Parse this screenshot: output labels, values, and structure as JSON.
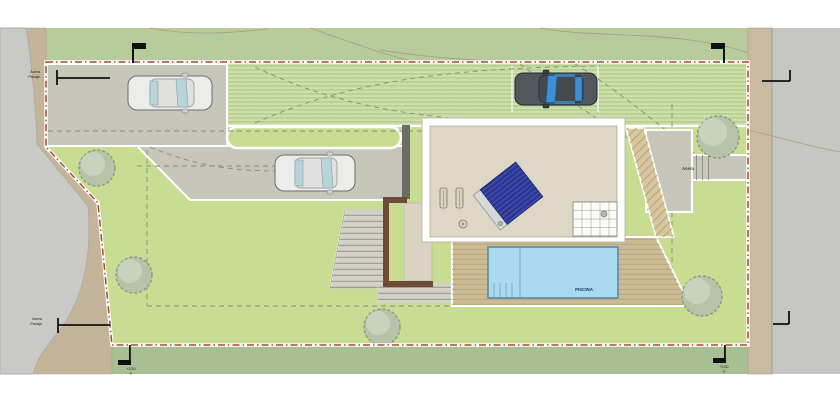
{
  "plan": {
    "pool_label": "PISCINA",
    "sidewalk_label_right": "Acera",
    "street_label_top": {
      "line1": "Acera",
      "line2": "Pasaje"
    },
    "street_label_bottom": {
      "line1": "Acera",
      "line2": "Pasaje"
    },
    "survey_marker_bottom_left": {
      "line1": "+3.50",
      "line2": "m"
    },
    "survey_marker_bottom_right": {
      "line1": "+3.50",
      "line2": "m"
    }
  },
  "colors": {
    "page": "#ffffff",
    "terrain": "#b7cb9c",
    "terrain_outer": "#a7bf92",
    "lawn": "#c8dc92",
    "paver_base": "#cfe0aa",
    "road": "#c9c9c5",
    "road_right": "#c6c6c2",
    "sidewalk": "#c4b49a",
    "sidewalk_right": "#c9baa1",
    "driveway": "#c7c6bb",
    "roof": "#ded7c6",
    "house_frame": "#ffffff",
    "deck": "#cdbb96",
    "hatch_path": "#d8c69f",
    "pool": "#a8dbee",
    "pool_border": "#50809c",
    "pool_text": "#1b2f6b",
    "solar": "#2c3690",
    "court": "#dbd3c2",
    "wall_dark": "#6c6c64",
    "wall_brown": "#6e4a37",
    "stairs": "#d3d2c8",
    "tree": "#b6c3a9",
    "tree_stroke": "#84967e",
    "boundary": "#a34b30",
    "guide_dash": "#8a8a7c",
    "contour": "#a79e82",
    "marker_black": "#111111"
  }
}
